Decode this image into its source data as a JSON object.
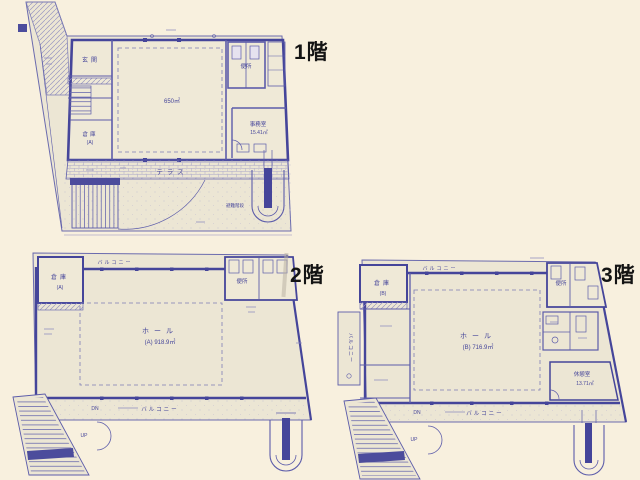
{
  "palette": {
    "paper": "#f8f0de",
    "plan_paper": "#ece6d4",
    "ink": "#5c5caa",
    "wall": "#45459a",
    "title_color": "#141414"
  },
  "floors": {
    "f1": {
      "title": "1階",
      "labels": {
        "entrance": "玄関",
        "storage": "倉庫",
        "storage_sub": "(A)",
        "hall_area": "650㎡",
        "toilet": "便所",
        "office": "事務室",
        "office_area": "15.41㎡",
        "terrace": "テラス",
        "escape_stair": "避難階段"
      }
    },
    "f2": {
      "title": "2階",
      "labels": {
        "storage": "倉庫",
        "storage_sub": "(A)",
        "toilet": "便所",
        "hall": "ホール",
        "hall_area": "(A) 918.9㎡",
        "balcony_top": "バルコニー",
        "balcony_bottom": "バルコニー",
        "dn": "DN",
        "up": "UP"
      }
    },
    "f3": {
      "title": "3階",
      "labels": {
        "storage": "倉庫",
        "storage_sub": "(B)",
        "toilet": "便所",
        "hall": "ホール",
        "hall_area": "(B) 716.9㎡",
        "rest_room": "休憩室",
        "rest_area": "13.71㎡",
        "balcony_top": "バルコニー",
        "balcony_left": "バルコニー",
        "balcony_bottom": "バルコニー",
        "dn": "DN",
        "up": "UP"
      }
    }
  }
}
